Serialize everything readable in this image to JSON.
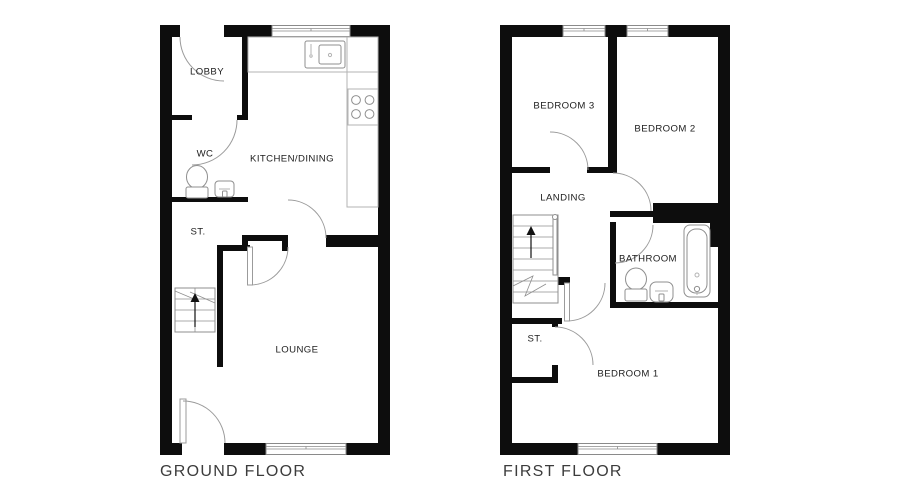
{
  "colors": {
    "background": "#ffffff",
    "wall": "#0d0d0d",
    "fixture_line": "#8f8f8f",
    "door_arc": "#9b9b9b",
    "room_label_text": "#1c1c1c",
    "floor_title_text": "#3c3c3c"
  },
  "floors": [
    {
      "id": "ground-floor",
      "title": "GROUND FLOOR",
      "rooms": [
        {
          "label": "LOBBY"
        },
        {
          "label": "WC"
        },
        {
          "label": "KITCHEN/DINING"
        },
        {
          "label": "ST."
        },
        {
          "label": "LOUNGE"
        }
      ],
      "fixtures": [
        "entrance-door",
        "wc-toilet",
        "wc-basin",
        "kitchen-counter",
        "kitchen-sink",
        "kitchen-hob",
        "stairs-up",
        "rear-door",
        "front-window",
        "rear-window"
      ]
    },
    {
      "id": "first-floor",
      "title": "FIRST FLOOR",
      "rooms": [
        {
          "label": "BEDROOM 3"
        },
        {
          "label": "BEDROOM 2"
        },
        {
          "label": "LANDING"
        },
        {
          "label": "BATHROOM"
        },
        {
          "label": "ST."
        },
        {
          "label": "BEDROOM 1"
        }
      ],
      "fixtures": [
        "stairs-up",
        "bathtub",
        "toilet",
        "basin",
        "bedroom3-window",
        "bedroom2-window",
        "bedroom1-window"
      ]
    }
  ]
}
